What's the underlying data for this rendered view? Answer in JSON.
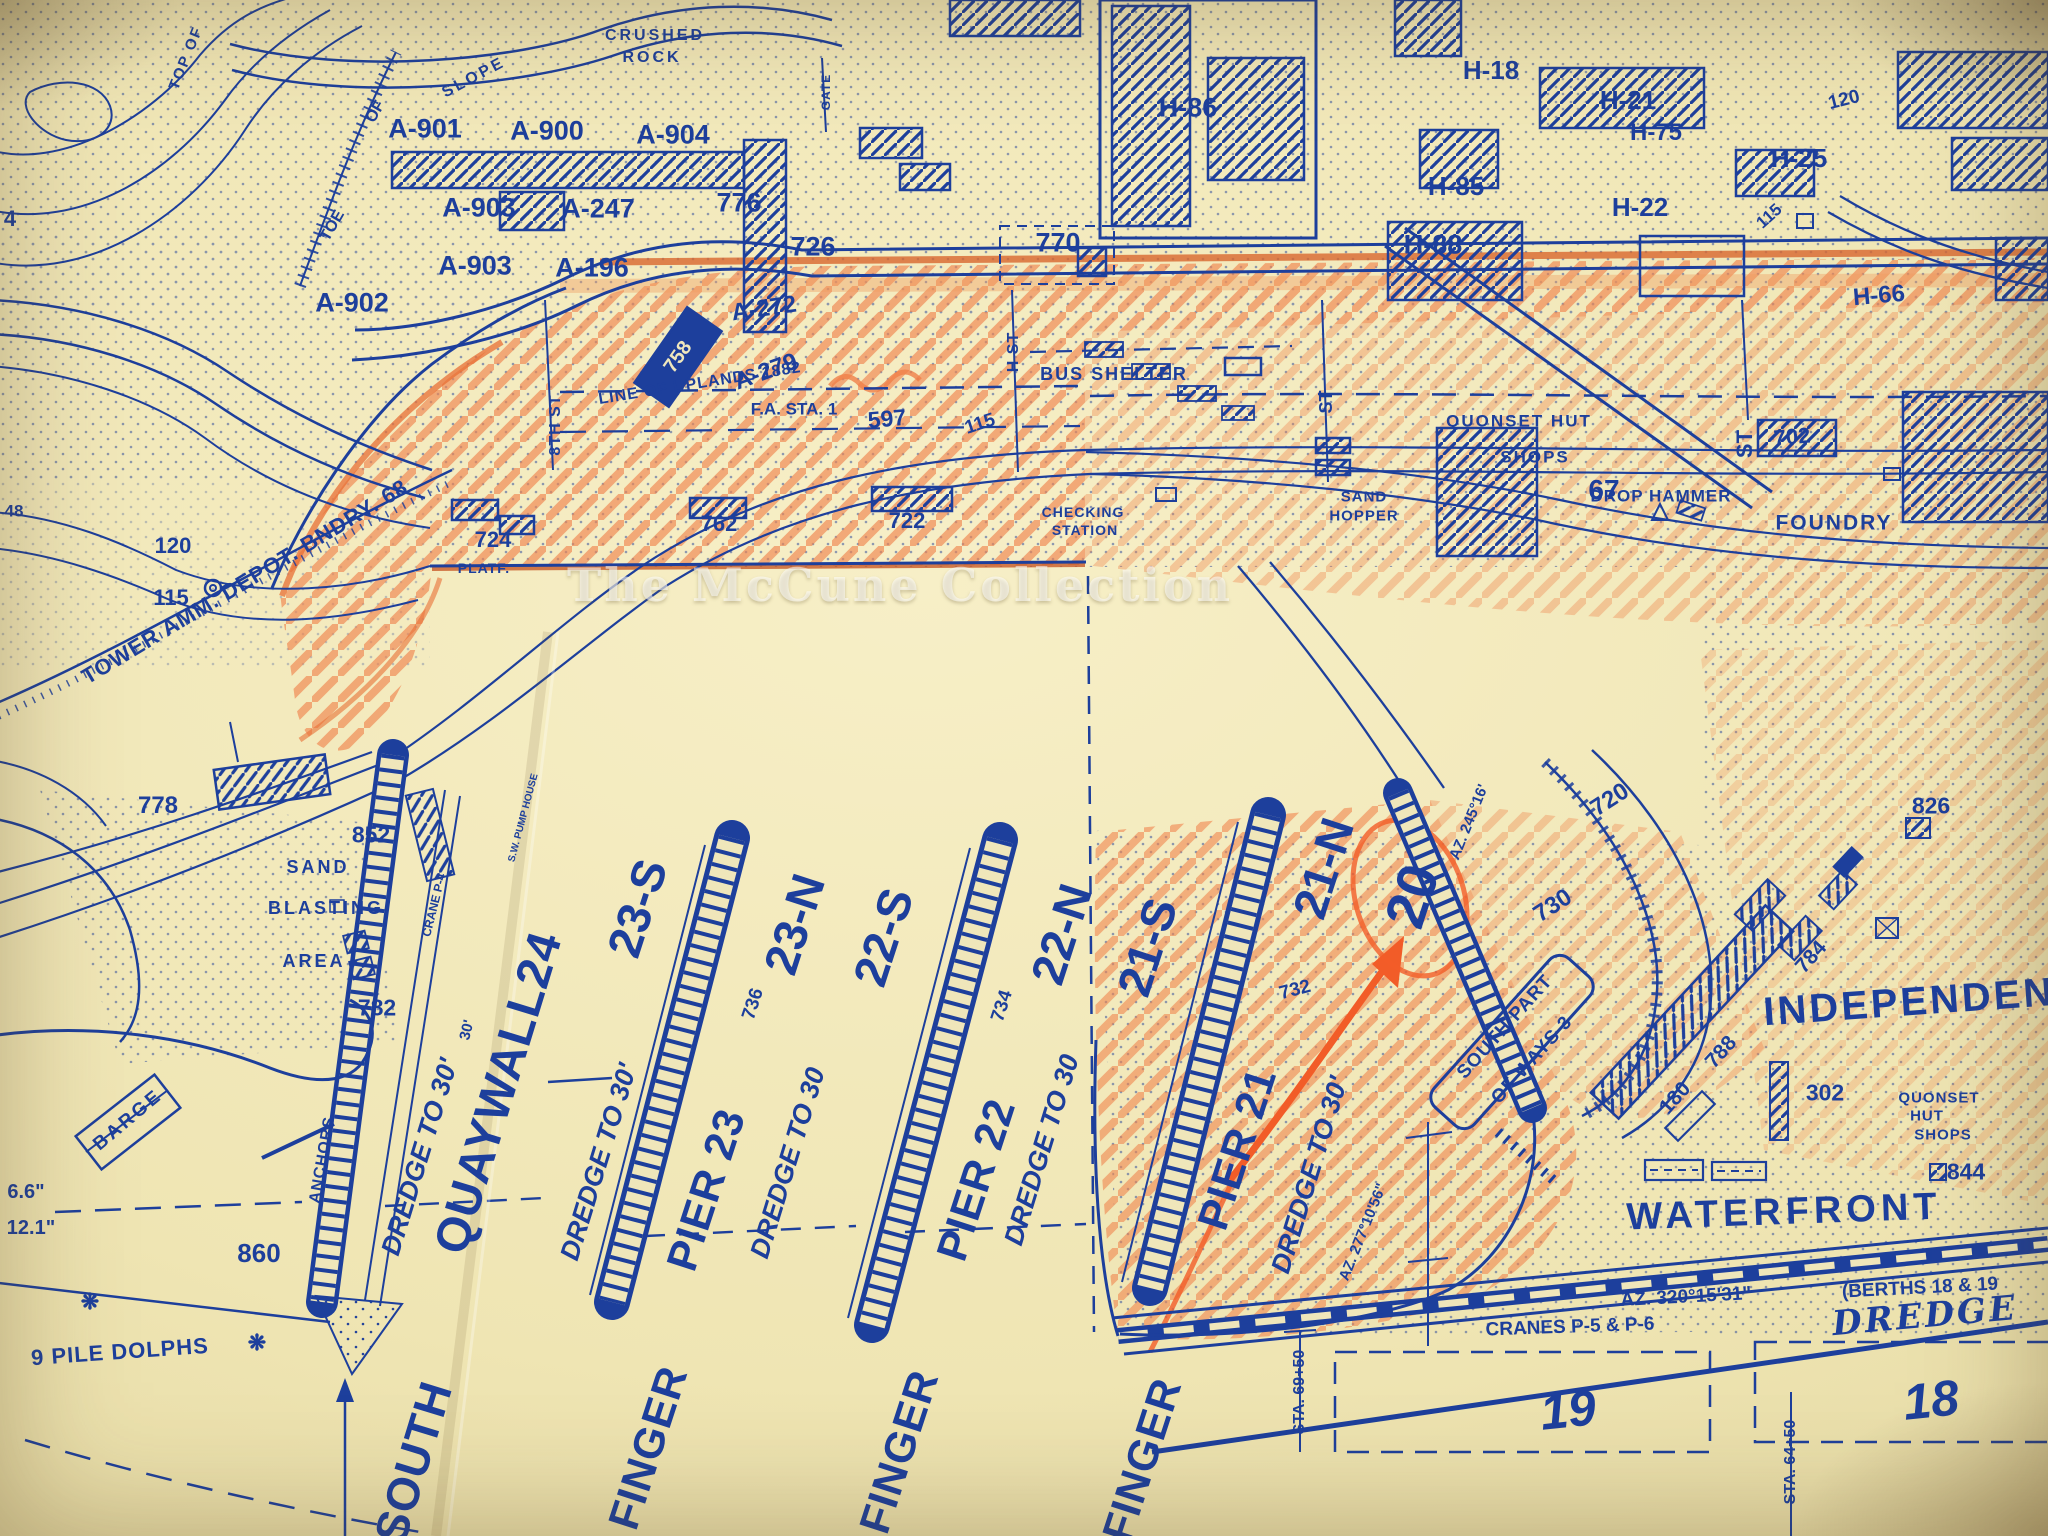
{
  "map": {
    "watermark": "The McCune Collection",
    "colors": {
      "paper": "#efe5b5",
      "ink": "#1d3f9c",
      "crayon": "#ee7a42"
    },
    "labels": [
      {
        "text": "TOP OF",
        "x": 186,
        "y": 58,
        "size": 15,
        "rot": -68,
        "ls": 2
      },
      {
        "text": "TOE",
        "x": 333,
        "y": 226,
        "size": 16,
        "rot": -60
      },
      {
        "text": "OF",
        "x": 376,
        "y": 112,
        "size": 16,
        "rot": -60
      },
      {
        "text": "SLOPE",
        "x": 474,
        "y": 78,
        "size": 16,
        "rot": -28,
        "ls": 3
      },
      {
        "text": "CRUSHED",
        "x": 655,
        "y": 36,
        "size": 16,
        "ls": 3
      },
      {
        "text": "ROCK",
        "x": 652,
        "y": 58,
        "size": 16,
        "ls": 3
      },
      {
        "text": "GATE",
        "x": 826,
        "y": 92,
        "size": 12,
        "rot": -90,
        "ls": 1
      },
      {
        "text": "A-901",
        "x": 425,
        "y": 129,
        "size": 27
      },
      {
        "text": "A-900",
        "x": 547,
        "y": 131,
        "size": 27
      },
      {
        "text": "A-904",
        "x": 673,
        "y": 135,
        "size": 27
      },
      {
        "text": "A-903",
        "x": 479,
        "y": 208,
        "size": 27
      },
      {
        "text": "A-247",
        "x": 598,
        "y": 209,
        "size": 27
      },
      {
        "text": "776",
        "x": 739,
        "y": 203,
        "size": 27
      },
      {
        "text": "726",
        "x": 813,
        "y": 247,
        "size": 27
      },
      {
        "text": "A-903",
        "x": 475,
        "y": 266,
        "size": 27
      },
      {
        "text": "A-196",
        "x": 592,
        "y": 268,
        "size": 27
      },
      {
        "text": "A-902",
        "x": 352,
        "y": 303,
        "size": 27
      },
      {
        "text": "A-272",
        "x": 764,
        "y": 309,
        "size": 24,
        "rot": -8
      },
      {
        "text": "A-279",
        "x": 766,
        "y": 372,
        "size": 24,
        "rot": -20
      },
      {
        "text": "758",
        "x": 678,
        "y": 357,
        "size": 20,
        "rot": -55,
        "color": "#efe7bd"
      },
      {
        "text": "770",
        "x": 1058,
        "y": 243,
        "size": 27
      },
      {
        "text": "H-86",
        "x": 1188,
        "y": 108,
        "size": 27
      },
      {
        "text": "H-18",
        "x": 1491,
        "y": 70,
        "size": 26
      },
      {
        "text": "H-21",
        "x": 1628,
        "y": 100,
        "size": 26
      },
      {
        "text": "H-75",
        "x": 1656,
        "y": 133,
        "size": 24
      },
      {
        "text": "H-85",
        "x": 1456,
        "y": 186,
        "size": 26
      },
      {
        "text": "H-22",
        "x": 1640,
        "y": 207,
        "size": 26
      },
      {
        "text": "H-25",
        "x": 1799,
        "y": 158,
        "size": 26
      },
      {
        "text": "H-88",
        "x": 1433,
        "y": 245,
        "size": 27
      },
      {
        "text": "H-66",
        "x": 1879,
        "y": 296,
        "size": 24,
        "rot": -5
      },
      {
        "text": "120",
        "x": 1844,
        "y": 100,
        "size": 19,
        "rot": -14
      },
      {
        "text": "115",
        "x": 1769,
        "y": 216,
        "size": 17,
        "rot": -42
      },
      {
        "text": "4",
        "x": 10,
        "y": 219,
        "size": 22
      },
      {
        "text": "48",
        "x": 14,
        "y": 511,
        "size": 17
      },
      {
        "text": "120",
        "x": 173,
        "y": 546,
        "size": 22
      },
      {
        "text": "115",
        "x": 171,
        "y": 598,
        "size": 22
      },
      {
        "text": "TOWER AMM. DEPOT. BNDRY. 68",
        "x": 245,
        "y": 582,
        "size": 22,
        "rot": -31,
        "ls": 1
      },
      {
        "text": "778",
        "x": 158,
        "y": 806,
        "size": 24
      },
      {
        "text": "LINE OF UPLANDS 1882",
        "x": 700,
        "y": 384,
        "size": 16,
        "rot": -9,
        "ls": 1
      },
      {
        "text": "597",
        "x": 887,
        "y": 419,
        "size": 23,
        "rot": -5
      },
      {
        "text": "115",
        "x": 980,
        "y": 424,
        "size": 19,
        "rot": -18
      },
      {
        "text": "F.A. STA. 1",
        "x": 794,
        "y": 409,
        "size": 17
      },
      {
        "text": "BUS SHELTER",
        "x": 1114,
        "y": 374,
        "size": 18,
        "ls": 2
      },
      {
        "text": "8TH ST",
        "x": 556,
        "y": 425,
        "size": 16,
        "rot": -90,
        "ls": 1
      },
      {
        "text": "H ST",
        "x": 1014,
        "y": 352,
        "size": 16,
        "rot": -90,
        "ls": 1
      },
      {
        "text": "ST",
        "x": 1326,
        "y": 402,
        "size": 18,
        "rot": -90
      },
      {
        "text": "ST",
        "x": 1745,
        "y": 444,
        "size": 22,
        "rot": -90
      },
      {
        "text": "QUONSET HUT",
        "x": 1519,
        "y": 421,
        "size": 17,
        "ls": 2
      },
      {
        "text": "SHOPS",
        "x": 1535,
        "y": 457,
        "size": 17,
        "ls": 2
      },
      {
        "text": "DROP HAMMER",
        "x": 1661,
        "y": 496,
        "size": 17,
        "ls": 1
      },
      {
        "text": "702",
        "x": 1792,
        "y": 437,
        "size": 22,
        "rot": -5
      },
      {
        "text": "FOUNDRY",
        "x": 1834,
        "y": 523,
        "size": 21,
        "ls": 2
      },
      {
        "text": "67",
        "x": 1604,
        "y": 490,
        "size": 28
      },
      {
        "text": "SAND",
        "x": 1364,
        "y": 497,
        "size": 15,
        "ls": 1
      },
      {
        "text": "HOPPER",
        "x": 1364,
        "y": 516,
        "size": 15,
        "ls": 1
      },
      {
        "text": "CHECKING",
        "x": 1083,
        "y": 512,
        "size": 14,
        "ls": 1
      },
      {
        "text": "STATION",
        "x": 1085,
        "y": 530,
        "size": 14,
        "ls": 1
      },
      {
        "text": "724",
        "x": 493,
        "y": 540,
        "size": 22
      },
      {
        "text": "762",
        "x": 719,
        "y": 524,
        "size": 22
      },
      {
        "text": "722",
        "x": 907,
        "y": 521,
        "size": 22
      },
      {
        "text": "PLATF.",
        "x": 484,
        "y": 568,
        "size": 14,
        "ls": 1
      },
      {
        "text": "852",
        "x": 371,
        "y": 835,
        "size": 23
      },
      {
        "text": "SAND",
        "x": 318,
        "y": 867,
        "size": 18,
        "ls": 3
      },
      {
        "text": "BLASTING",
        "x": 326,
        "y": 908,
        "size": 18,
        "ls": 3
      },
      {
        "text": "AREA",
        "x": 314,
        "y": 961,
        "size": 18,
        "ls": 3
      },
      {
        "text": "782",
        "x": 377,
        "y": 1008,
        "size": 23
      },
      {
        "text": "S.W. PUMP HOUSE",
        "x": 524,
        "y": 818,
        "size": 10,
        "rot": -75
      },
      {
        "text": "CRANE P-4",
        "x": 434,
        "y": 905,
        "size": 12,
        "rot": -76
      },
      {
        "text": "30'",
        "x": 467,
        "y": 1030,
        "size": 15,
        "rot": -76
      },
      {
        "text": "DREDGE TO 30'",
        "x": 420,
        "y": 1157,
        "size": 27,
        "rot": -73,
        "italic": true
      },
      {
        "text": "QUAYWALL24",
        "x": 499,
        "y": 1093,
        "size": 48,
        "rot": -73,
        "ls": 1
      },
      {
        "text": "SOUTH",
        "x": 413,
        "y": 1462,
        "size": 46,
        "rot": -73,
        "ls": 1
      },
      {
        "text": "DREDGE TO 30'",
        "x": 599,
        "y": 1162,
        "size": 27,
        "rot": -73,
        "italic": true
      },
      {
        "text": "23-S",
        "x": 637,
        "y": 908,
        "size": 47,
        "rot": -72
      },
      {
        "text": "736",
        "x": 753,
        "y": 1004,
        "size": 19,
        "rot": -72
      },
      {
        "text": "PIER 23",
        "x": 707,
        "y": 1190,
        "size": 43,
        "rot": -72,
        "ls": 1
      },
      {
        "text": "FINGER",
        "x": 649,
        "y": 1448,
        "size": 43,
        "rot": -72,
        "ls": 1
      },
      {
        "text": "DREDGE TO 30",
        "x": 788,
        "y": 1163,
        "size": 27,
        "rot": -73,
        "italic": true
      },
      {
        "text": "23-N",
        "x": 794,
        "y": 924,
        "size": 47,
        "rot": -72
      },
      {
        "text": "22-S",
        "x": 883,
        "y": 937,
        "size": 47,
        "rot": -72
      },
      {
        "text": "734",
        "x": 1002,
        "y": 1006,
        "size": 19,
        "rot": -72
      },
      {
        "text": "PIER 22",
        "x": 977,
        "y": 1180,
        "size": 43,
        "rot": -72,
        "ls": 1
      },
      {
        "text": "FINGER",
        "x": 900,
        "y": 1452,
        "size": 43,
        "rot": -72,
        "ls": 1
      },
      {
        "text": "DREDGE TO 30",
        "x": 1042,
        "y": 1150,
        "size": 27,
        "rot": -73,
        "italic": true
      },
      {
        "text": "22-N",
        "x": 1061,
        "y": 934,
        "size": 47,
        "rot": -72
      },
      {
        "text": "21-S",
        "x": 1147,
        "y": 947,
        "size": 47,
        "rot": -72
      },
      {
        "text": "732",
        "x": 1295,
        "y": 990,
        "size": 19,
        "rot": -15
      },
      {
        "text": "21-N",
        "x": 1323,
        "y": 868,
        "size": 47,
        "rot": -72
      },
      {
        "text": "PIER 21",
        "x": 1238,
        "y": 1149,
        "size": 43,
        "rot": -72,
        "ls": 1
      },
      {
        "text": "FINGER",
        "x": 1143,
        "y": 1460,
        "size": 43,
        "rot": -72,
        "ls": 1
      },
      {
        "text": "DREDGE TO 30'",
        "x": 1310,
        "y": 1175,
        "size": 27,
        "rot": -73,
        "italic": true
      },
      {
        "text": "20",
        "x": 1412,
        "y": 896,
        "size": 56,
        "rot": -72
      },
      {
        "text": "AZ. 245°16'",
        "x": 1469,
        "y": 822,
        "size": 15,
        "rot": -68
      },
      {
        "text": "AZ. 277°10'56\"",
        "x": 1363,
        "y": 1232,
        "size": 15,
        "rot": -68
      },
      {
        "text": "SOUTH PART",
        "x": 1505,
        "y": 1027,
        "size": 19,
        "rot": -48,
        "ls": 1
      },
      {
        "text": "OF WAYS 3",
        "x": 1532,
        "y": 1060,
        "size": 19,
        "rot": -48,
        "ls": 1
      },
      {
        "text": "720",
        "x": 1610,
        "y": 800,
        "size": 24,
        "rot": -33
      },
      {
        "text": "730",
        "x": 1553,
        "y": 906,
        "size": 24,
        "rot": -33
      },
      {
        "text": "180",
        "x": 1675,
        "y": 1098,
        "size": 21,
        "rot": -48
      },
      {
        "text": "788",
        "x": 1721,
        "y": 1052,
        "size": 21,
        "rot": -48
      },
      {
        "text": "784",
        "x": 1811,
        "y": 957,
        "size": 21,
        "rot": -48
      },
      {
        "text": "826",
        "x": 1931,
        "y": 806,
        "size": 23
      },
      {
        "text": "INDEPENDENCE",
        "x": 1940,
        "y": 1000,
        "size": 40,
        "rot": -4,
        "ls": 3
      },
      {
        "text": "302",
        "x": 1825,
        "y": 1093,
        "size": 23
      },
      {
        "text": "QUONSET",
        "x": 1939,
        "y": 1098,
        "size": 15,
        "ls": 1
      },
      {
        "text": "HUT",
        "x": 1927,
        "y": 1116,
        "size": 15,
        "ls": 1
      },
      {
        "text": "SHOPS",
        "x": 1943,
        "y": 1135,
        "size": 15,
        "ls": 1
      },
      {
        "text": "844",
        "x": 1966,
        "y": 1172,
        "size": 23
      },
      {
        "text": "WATERFRONT",
        "x": 1784,
        "y": 1212,
        "size": 38,
        "rot": -2,
        "ls": 5
      },
      {
        "text": "AZ. 320°15'31\"",
        "x": 1686,
        "y": 1297,
        "size": 19,
        "rot": -3
      },
      {
        "text": "(BERTHS 18 & 19",
        "x": 1920,
        "y": 1288,
        "size": 19,
        "rot": -3
      },
      {
        "text": "CRANES P-5 & P-6",
        "x": 1570,
        "y": 1327,
        "size": 19,
        "rot": -2
      },
      {
        "text": "DREDGE",
        "x": 1925,
        "y": 1316,
        "size": 34,
        "rot": -5,
        "italic": true,
        "serif": true,
        "ls": 3
      },
      {
        "text": "19",
        "x": 1568,
        "y": 1410,
        "size": 50,
        "rot": -6,
        "italic": true
      },
      {
        "text": "18",
        "x": 1931,
        "y": 1400,
        "size": 50,
        "rot": -6,
        "italic": true
      },
      {
        "text": "STA. 69+50",
        "x": 1300,
        "y": 1392,
        "size": 16,
        "rot": -90
      },
      {
        "text": "STA. 64+50",
        "x": 1791,
        "y": 1462,
        "size": 16,
        "rot": -90
      },
      {
        "text": "BARGE",
        "x": 128,
        "y": 1120,
        "size": 19,
        "rot": -40,
        "ls": 3
      },
      {
        "text": "ANCHORS",
        "x": 323,
        "y": 1160,
        "size": 16,
        "rot": -80,
        "ls": 1
      },
      {
        "text": "6.6\"",
        "x": 26,
        "y": 1192,
        "size": 20
      },
      {
        "text": "12.1\"",
        "x": 31,
        "y": 1228,
        "size": 20
      },
      {
        "text": "860",
        "x": 259,
        "y": 1253,
        "size": 26
      },
      {
        "text": "❋",
        "x": 90,
        "y": 1302,
        "size": 22,
        "name": "pile-dolphin-marker"
      },
      {
        "text": "❋",
        "x": 257,
        "y": 1343,
        "size": 22,
        "name": "pile-dolphin-marker"
      },
      {
        "text": "9 PILE DOLPHS",
        "x": 120,
        "y": 1352,
        "size": 22,
        "rot": -4,
        "ls": 1
      }
    ]
  }
}
